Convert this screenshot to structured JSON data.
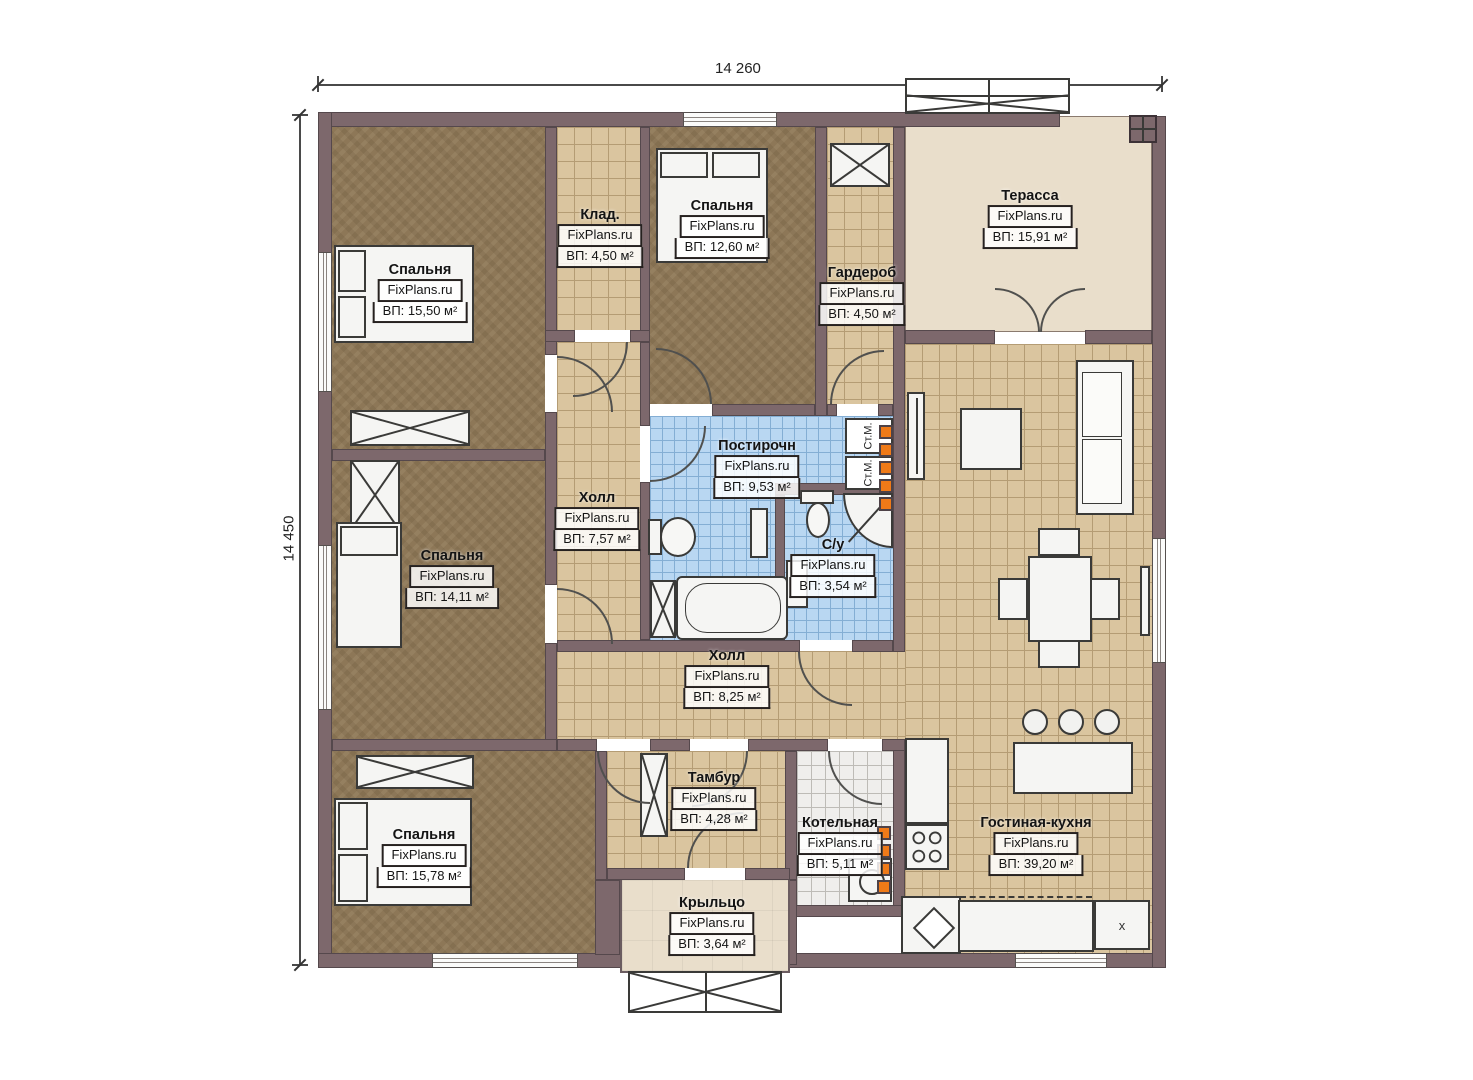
{
  "plan": {
    "dimensions": {
      "width": "14 260",
      "height": "14 450"
    },
    "watermark": "FixPlans.ru",
    "labels": {
      "washer": "Ст.М.",
      "cabinet_x": "x"
    },
    "rooms": [
      {
        "name": "Спальня",
        "area": "ВП: 15,50 м²"
      },
      {
        "name": "Клад.",
        "area": "ВП: 4,50 м²"
      },
      {
        "name": "Спальня",
        "area": "ВП: 12,60 м²"
      },
      {
        "name": "Гардероб",
        "area": "ВП: 4,50 м²"
      },
      {
        "name": "Терасса",
        "area": "ВП: 15,91 м²"
      },
      {
        "name": "Холл",
        "area": "ВП: 7,57 м²"
      },
      {
        "name": "Постирочн",
        "area": "ВП: 9,53 м²"
      },
      {
        "name": "С/у",
        "area": "ВП: 3,54 м²"
      },
      {
        "name": "Спальня",
        "area": "ВП: 14,11 м²"
      },
      {
        "name": "Холл",
        "area": "ВП: 8,25 м²"
      },
      {
        "name": "Спальня",
        "area": "ВП: 15,78 м²"
      },
      {
        "name": "Тамбур",
        "area": "ВП: 4,28 м²"
      },
      {
        "name": "Котельная",
        "area": "ВП: 5,11 м²"
      },
      {
        "name": "Крыльцо",
        "area": "ВП: 3,64 м²"
      },
      {
        "name": "Гостиная-кухня",
        "area": "ВП: 39,20 м²"
      }
    ],
    "colors": {
      "wall": "#7d686c",
      "wood": "#8d7757",
      "tile_beige": "#dac59f",
      "tile_blue": "#b9d7f2",
      "terrace": "#e9decb",
      "heat_accent": "#ef7a18"
    }
  }
}
